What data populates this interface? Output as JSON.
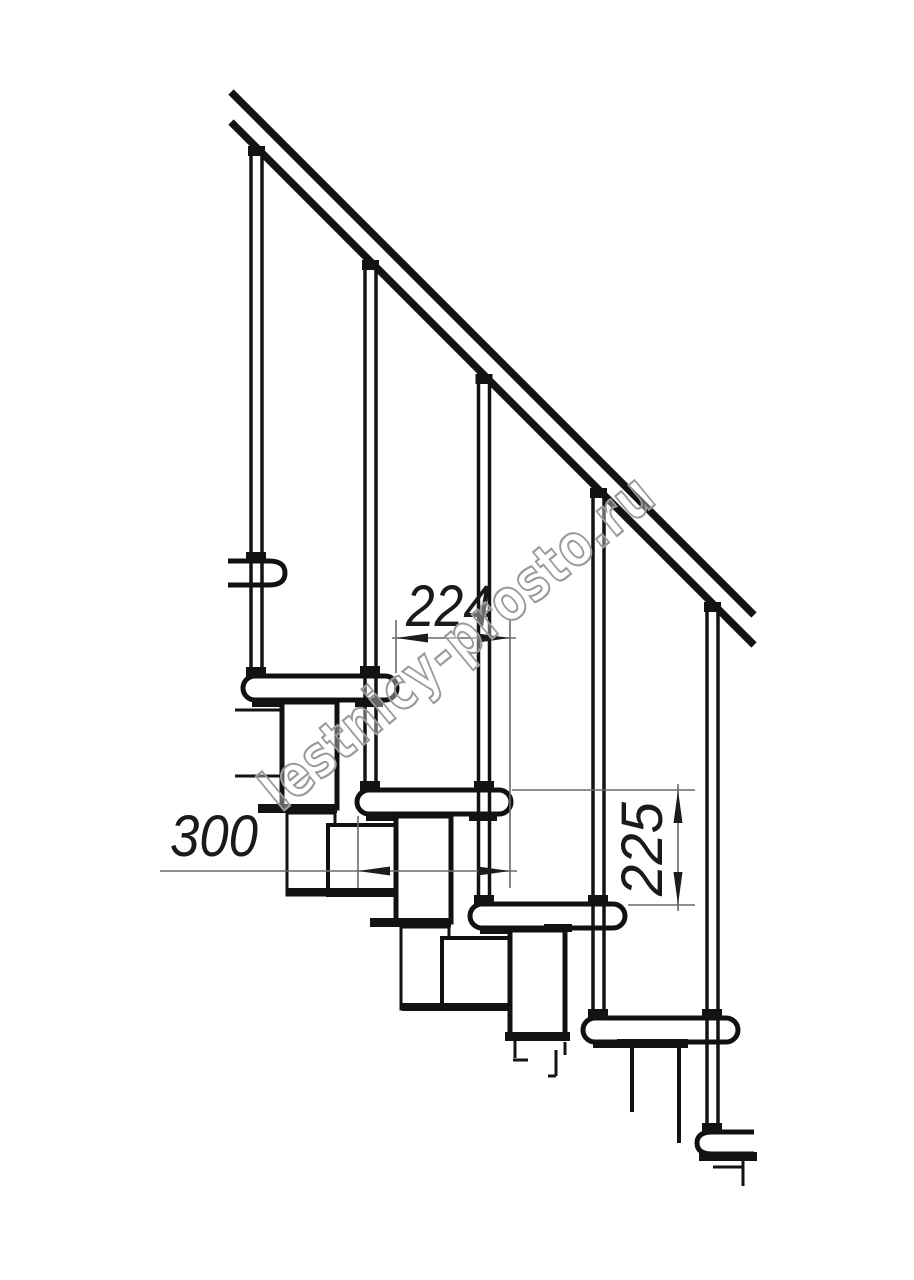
{
  "diagram": {
    "watermark": "lestnicy-prosto.ru",
    "dimensions": {
      "going": {
        "label": "224",
        "orientation": "horizontal"
      },
      "tread_depth": {
        "label": "300",
        "orientation": "horizontal"
      },
      "rise": {
        "label": "225",
        "orientation": "vertical"
      }
    },
    "colors": {
      "ink": "#131313",
      "dimension_line": "#6a6a6a",
      "arrow": "#1c1c1c",
      "watermark_outline": "#9a9a9a",
      "background": "#ffffff"
    }
  }
}
